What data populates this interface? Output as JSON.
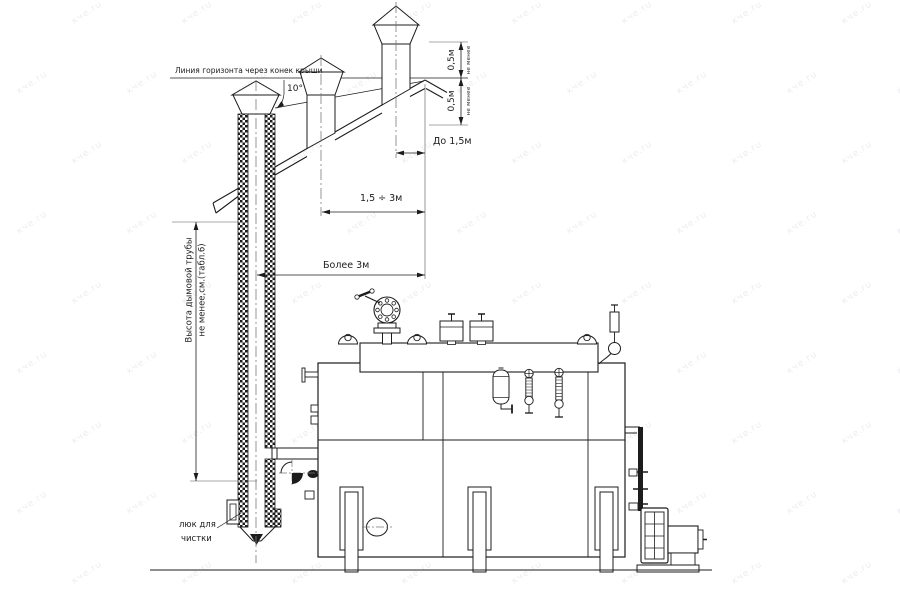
{
  "page": {
    "background": "#ffffff",
    "line_color": "#1c1c1c"
  },
  "watermark": {
    "text": "кче.ru"
  },
  "annotations": {
    "horizon_label": "Линия горизонта через конек крыши",
    "angle_label": "10°",
    "dim_ridge_upper": "0,5м",
    "dim_ridge_upper_qualifier": "не менее",
    "dim_ridge_lower": "0,5м",
    "dim_ridge_lower_qualifier": "не менее",
    "dim_distance_near": "До 1,5м",
    "dim_distance_mid": "1,5 ÷ 3м",
    "dim_distance_far": "Более 3м",
    "chimney_height_line1": "Высота дымовой трубы",
    "chimney_height_line2": "не менее,см.(табл.6)",
    "hatch_label_line1": "люк для",
    "hatch_label_line2": "чистки"
  }
}
